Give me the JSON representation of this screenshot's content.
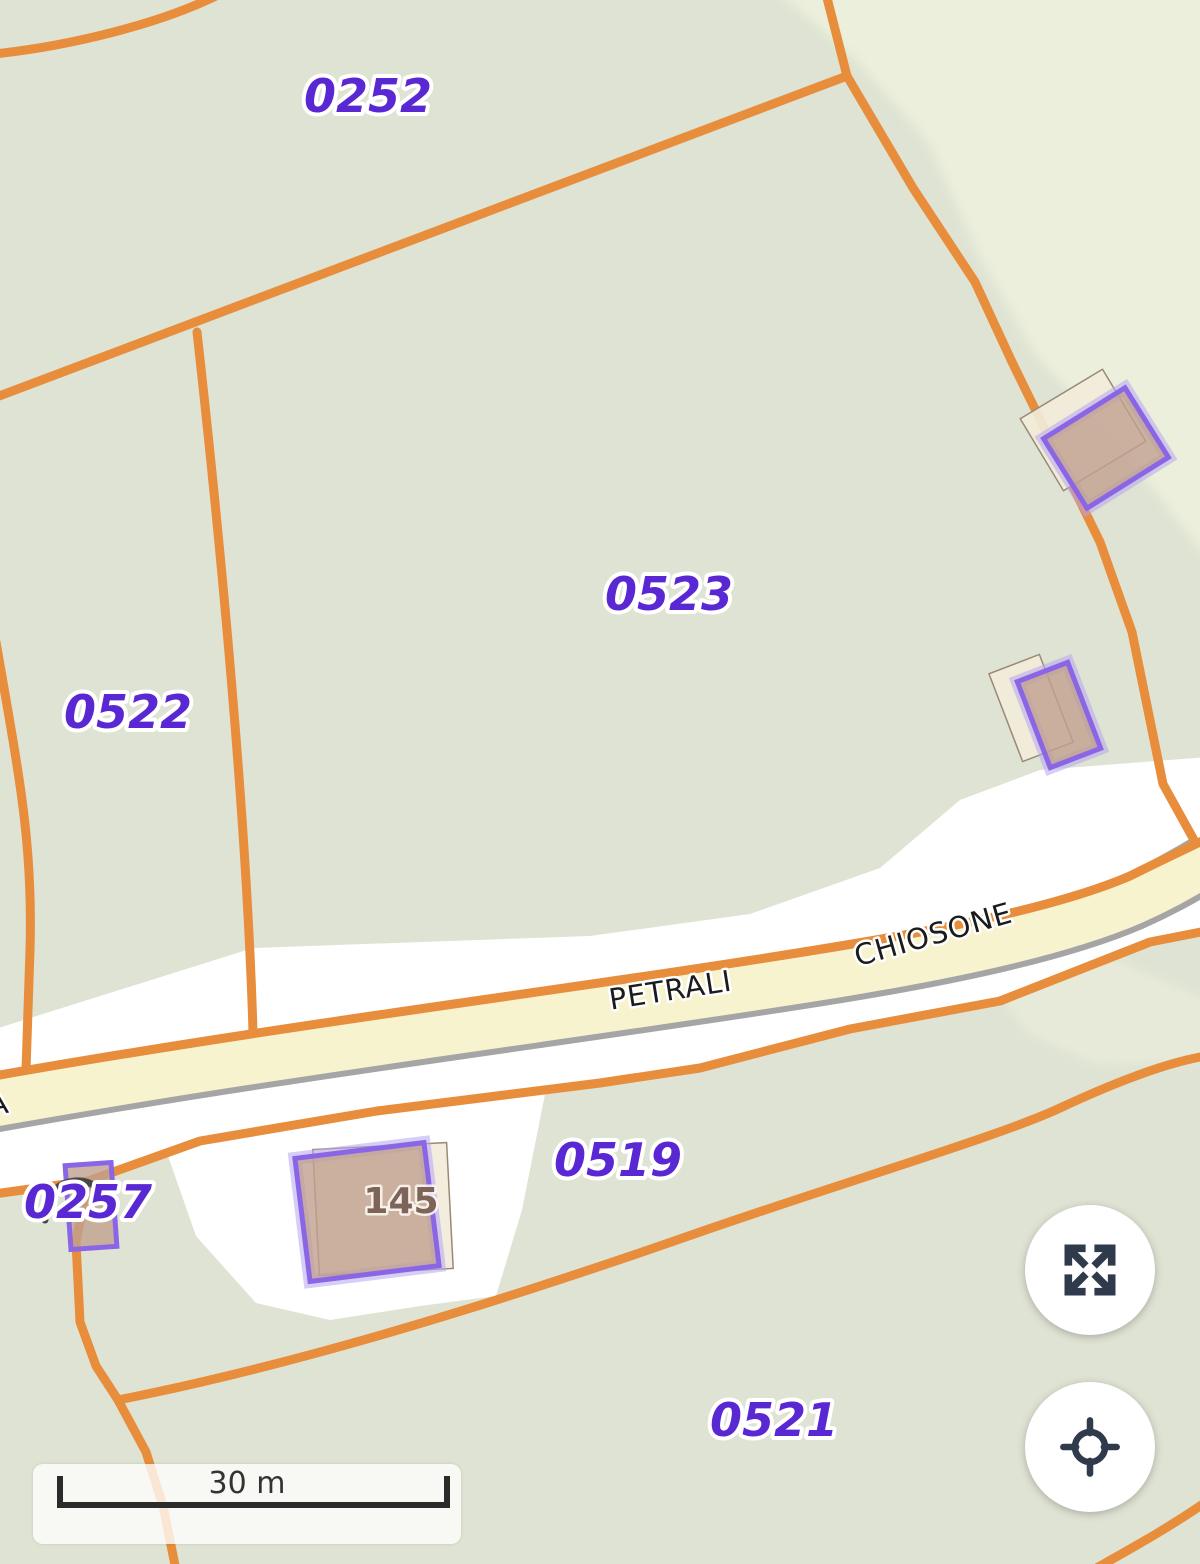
{
  "map_labels": {
    "parcel_0252": "0252",
    "parcel_0522": "0522",
    "parcel_0523": "0523",
    "parcel_0257": "0257",
    "parcel_0519": "0519",
    "parcel_0521": "0521"
  },
  "road_labels": {
    "petrali": "PETRALI",
    "chiosone": "CHIOSONE",
    "left_edge_fragment": "A"
  },
  "building_labels": {
    "house_number_145": "145"
  },
  "scale_bar": {
    "distance_label": "30 m"
  },
  "controls": {
    "fullscreen_button": "fullscreen",
    "locate_button": "locate"
  },
  "colors": {
    "background_green": "#dfe3d3",
    "background_light_green": "#ebefdb",
    "parcel_boundary_orange": "#e78d3b",
    "parcel_label_purple": "#5a28d2",
    "road_fill_yellow": "#f7f3cf",
    "road_casing_gray": "#a5a5a5",
    "road_corridor_white": "#ffffff",
    "cadastral_building_fill": "#c0a090",
    "cadastral_building_outline": "#8a66e6",
    "osm_building_fill": "#f2ecda",
    "osm_building_outline": "#9a8a74",
    "building_number_brown": "#7d6358",
    "icon_dark": "#2f3b4c"
  }
}
